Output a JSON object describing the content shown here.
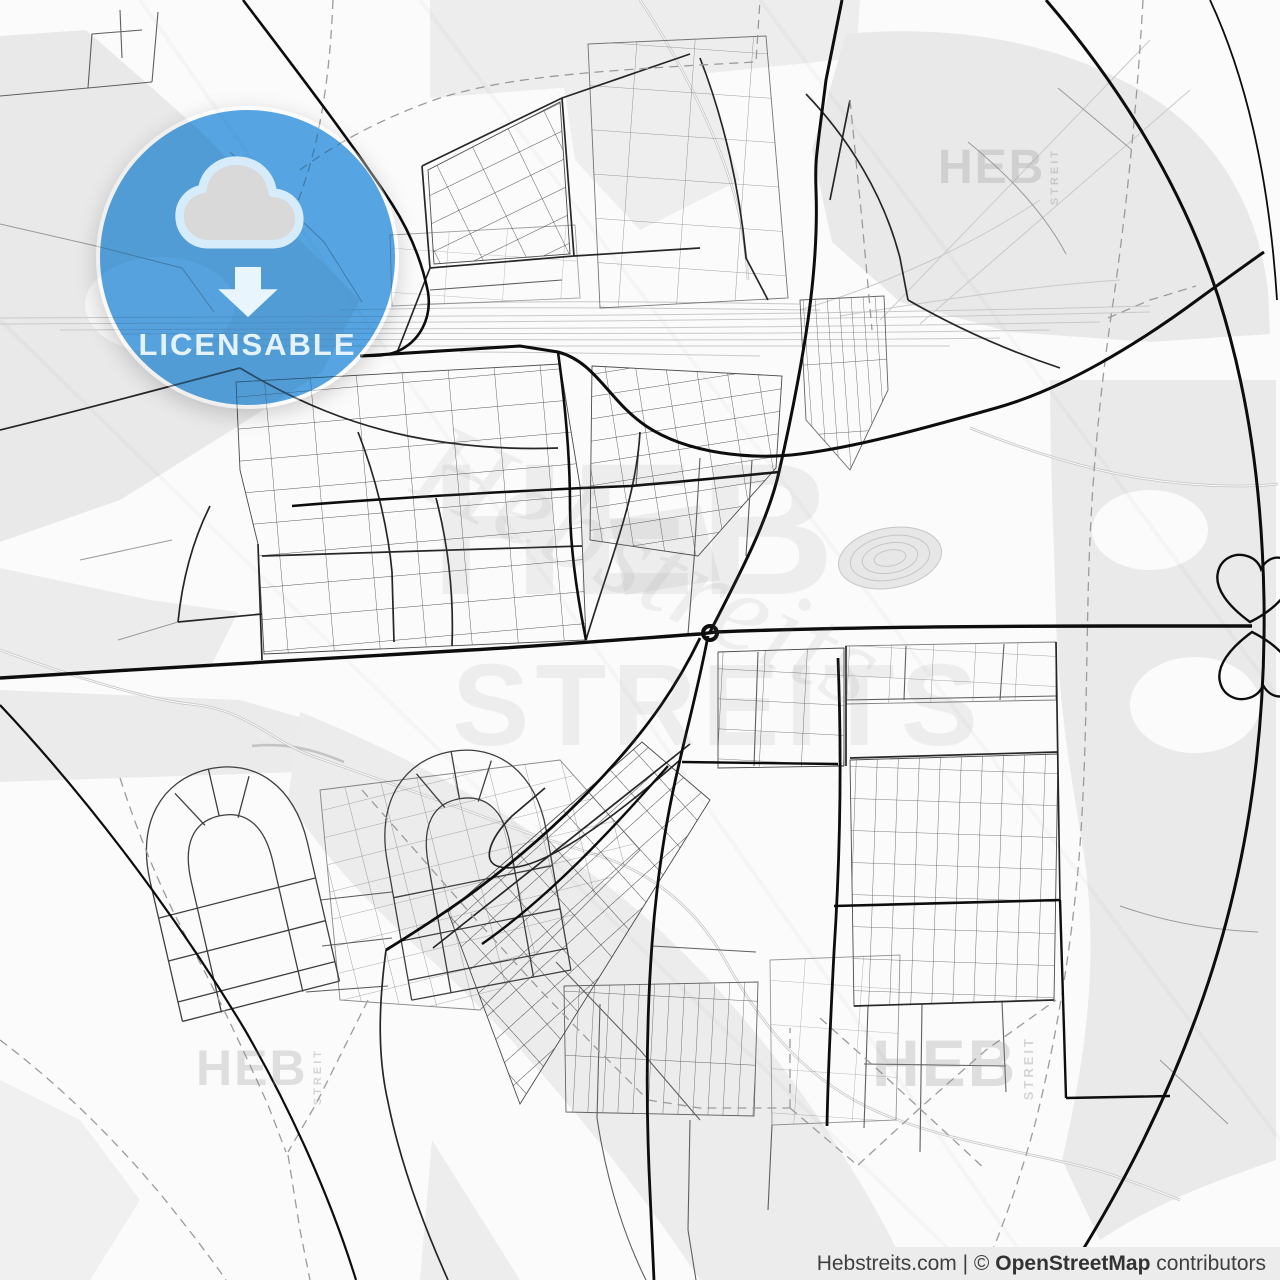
{
  "page": {
    "kind": "licensable-vector-map-preview",
    "width": 1280,
    "height": 1280
  },
  "badge": {
    "label": "LICENSABLE",
    "icon": "cloud-download-icon",
    "color": "#51a3e4"
  },
  "watermarks": {
    "brand_primary": "HEB",
    "brand_secondary": "STREITS",
    "brand_vertical": "STREIT",
    "brand_script": "Hebstreits"
  },
  "attribution": {
    "source": "Hebstreits.com",
    "divider": "|",
    "copyright": "©",
    "license": "OpenStreetMap",
    "suffix": "contributors"
  },
  "map": {
    "style": "light-gray-street-map",
    "features": [
      "street-network",
      "railway-yard",
      "ring-road-arcs",
      "central-roundabout",
      "cloverleaf-interchange",
      "residential-horseshoe-loops",
      "administrative-dashed-boundaries",
      "stream-paths"
    ],
    "colors": {
      "background": "#fbfbfb",
      "land": "#e9e9e9",
      "road_major": "#0d0d0d",
      "road_medium": "#262626",
      "road_minor": "#5f5f5f",
      "road_outskirt": "#9a9a9a",
      "railway": "#c9c9c9",
      "stream": "#c4c4c4",
      "boundary": "#9b9b9b",
      "attribution_bg": "#ececec"
    }
  }
}
